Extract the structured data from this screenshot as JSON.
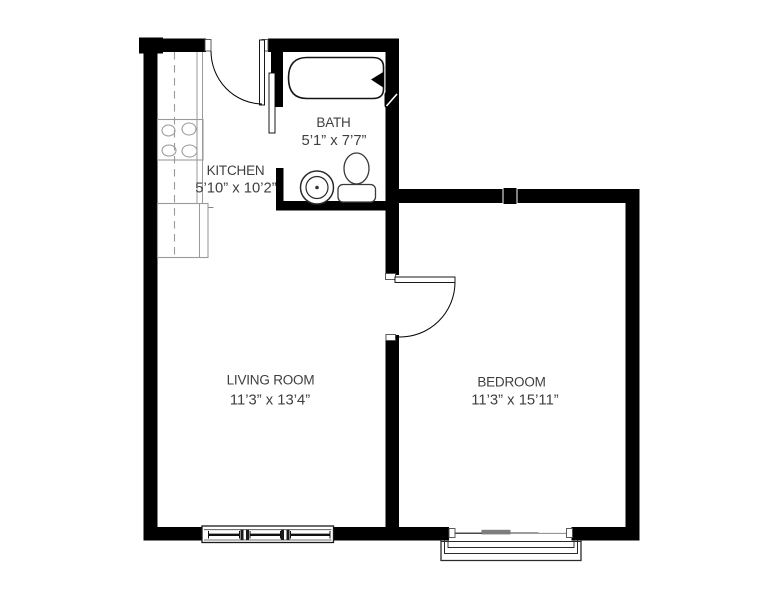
{
  "plan": {
    "rooms": {
      "bath": {
        "label": "BATH",
        "dimensions": "5’1” x 7’7”"
      },
      "kitchen": {
        "label": "KITCHEN",
        "dimensions": "5’10” x 10’2”"
      },
      "living_room": {
        "label": "LIVING ROOM",
        "dimensions": "11’3” x 13’4”"
      },
      "bedroom": {
        "label": "BEDROOM",
        "dimensions": "11’3” x 15’11”"
      }
    },
    "colors": {
      "background": "#ffffff",
      "wall": "#000000",
      "label_text": "#3f3f3f",
      "fixture_line": "#9a9a9a",
      "door_panel_gray": "#7d7d7d"
    },
    "fixture_icons": [
      "bathtub-icon",
      "faucet-icon",
      "toilet-icon",
      "sink-icon",
      "stove-icon",
      "kitchen-counter",
      "window",
      "sliding-glass-door",
      "balcony"
    ]
  }
}
